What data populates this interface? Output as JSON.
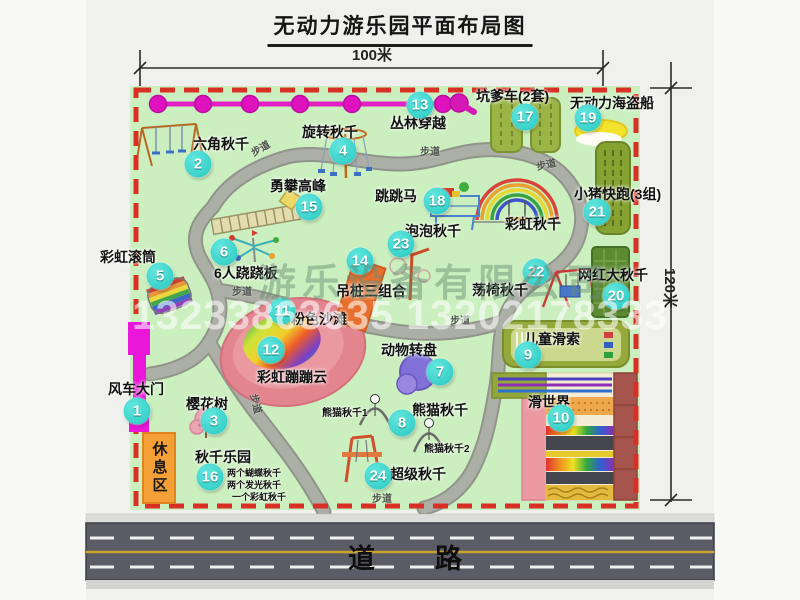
{
  "title": "无动力游乐园平面布局图",
  "dimensions": {
    "width": "100米",
    "height": "120米"
  },
  "road": {
    "label": "道路"
  },
  "watermark": {
    "company": "游乐设备有限公司",
    "phone": "13233863635 13202178333"
  },
  "map": {
    "walkway_label": "步道",
    "rest_area": "休息区",
    "rainbow_swing_label": "彩虹秋千",
    "panda_swing_1": "熊猫秋千1",
    "panda_swing_2": "熊猫秋千2",
    "swing_park_notes": [
      "两个蝴蝶秋千",
      "两个发光秋千",
      "一个彩虹秋千"
    ]
  },
  "attractions": [
    {
      "num": "1",
      "name": "风车大门"
    },
    {
      "num": "2",
      "name": "六角秋千"
    },
    {
      "num": "3",
      "name": "樱花树"
    },
    {
      "num": "4",
      "name": "旋转秋千"
    },
    {
      "num": "5",
      "name": "彩虹滚筒"
    },
    {
      "num": "6",
      "name": "6人跷跷板"
    },
    {
      "num": "7",
      "name": "动物转盘"
    },
    {
      "num": "8",
      "name": "熊猫秋千"
    },
    {
      "num": "9",
      "name": "儿童滑索"
    },
    {
      "num": "10",
      "name": "滑世界"
    },
    {
      "num": "11",
      "name": "粉色沙滩"
    },
    {
      "num": "12",
      "name": "彩虹蹦蹦云"
    },
    {
      "num": "13",
      "name": "丛林穿越"
    },
    {
      "num": "14",
      "name": "吊桩三组合"
    },
    {
      "num": "15",
      "name": "勇攀高峰"
    },
    {
      "num": "16",
      "name": "秋千乐园"
    },
    {
      "num": "17",
      "name": "坑爹车(2套)"
    },
    {
      "num": "18",
      "name": "跳跳马"
    },
    {
      "num": "19",
      "name": "无动力海盗船"
    },
    {
      "num": "20",
      "name": "网红大秋千"
    },
    {
      "num": "21",
      "name": "小猪快跑(3组)"
    },
    {
      "num": "22",
      "name": "荡椅秋千"
    },
    {
      "num": "23",
      "name": "泡泡秋千"
    },
    {
      "num": "24",
      "name": "超级秋千"
    }
  ],
  "colors": {
    "map_green": "#cbefbe",
    "border_red": "#d93025",
    "badge_teal": "#2fd0c8",
    "path_gray": "#a7aaa1",
    "gate_magenta": "#ea16d9",
    "road_gray": "#5c5c67",
    "zipline_pink": "#e020c4"
  }
}
